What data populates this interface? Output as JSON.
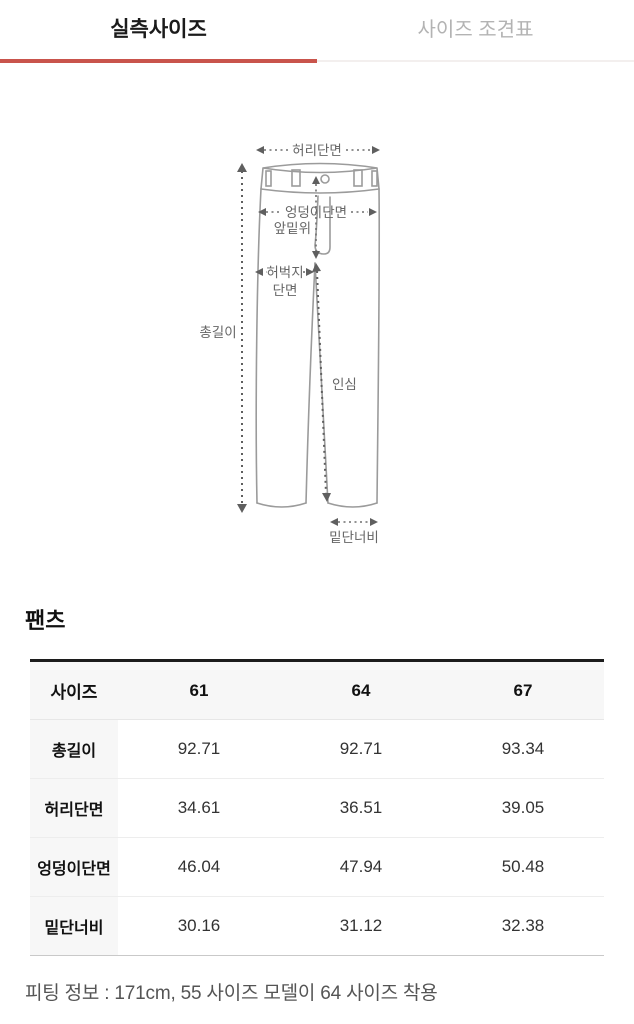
{
  "tabs": [
    {
      "label": "실측사이즈",
      "active": true
    },
    {
      "label": "사이즈 조견표",
      "active": false
    }
  ],
  "accent_color": "#c9544c",
  "diagram": {
    "labels": {
      "waist": "허리단면",
      "hip": "엉덩이단면",
      "front_rise": "앞밑위",
      "thigh_line1": "허벅지",
      "thigh_line2": "단면",
      "total_length": "총길이",
      "inseam": "인심",
      "hem_width": "밑단너비"
    }
  },
  "table": {
    "title": "팬츠",
    "header": [
      "사이즈",
      "61",
      "64",
      "67"
    ],
    "rows": [
      {
        "label": "총길이",
        "values": [
          "92.71",
          "92.71",
          "93.34"
        ]
      },
      {
        "label": "허리단면",
        "values": [
          "34.61",
          "36.51",
          "39.05"
        ]
      },
      {
        "label": "엉덩이단면",
        "values": [
          "46.04",
          "47.94",
          "50.48"
        ]
      },
      {
        "label": "밑단너비",
        "values": [
          "30.16",
          "31.12",
          "32.38"
        ]
      }
    ]
  },
  "footer": {
    "fitting_info": "피팅 정보 : 171cm, 55 사이즈 모델이 64 사이즈 착용"
  }
}
